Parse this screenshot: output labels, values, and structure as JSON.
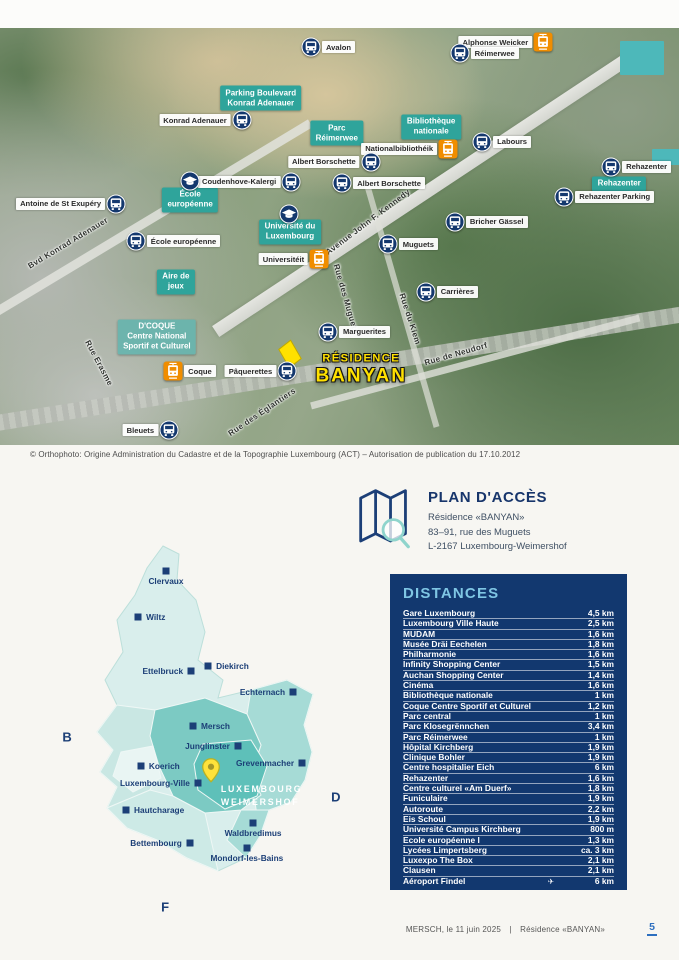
{
  "page": {
    "copyright": "© Orthophoto: Origine Administration du Cadastre et de la Topographie Luxembourg (ACT) – Autorisation de publication du 17.10.2012",
    "footer": {
      "left": "MERSCH, le 11 juin 2025",
      "separator": "|",
      "right": "Résidence «BANYAN»",
      "page_number": "5"
    }
  },
  "colors": {
    "teal_label": "#2fa49b",
    "navy_panel": "#12386f",
    "bus_icon_navy": "#14386e",
    "tram_icon_orange": "#f08d00",
    "residence_yellow": "#ffe100",
    "distances_title_blue": "#7fc6e4",
    "page_number_blue": "#2d6fbf",
    "city_navy": "#1c3f77"
  },
  "aerial_map": {
    "area_labels": [
      {
        "text": "Parking Boulevard\nKonrad Adenauer",
        "x": 38.4,
        "y": 16.8
      },
      {
        "text": "Parc\nRéimerwee",
        "x": 49.6,
        "y": 25.2
      },
      {
        "text": "Bibliothèque\nnationale",
        "x": 63.5,
        "y": 23.7
      },
      {
        "text": "École\neuropéenne",
        "x": 28.0,
        "y": 41.2
      },
      {
        "text": "Université du\nLuxembourg",
        "x": 42.7,
        "y": 48.9
      },
      {
        "text": "Aire de\njeux",
        "x": 25.9,
        "y": 60.9
      },
      {
        "text": "Rehazenter",
        "x": 91.2,
        "y": 37.4
      },
      {
        "text": "D'COQUE\nCentre National\nSportif et Culturel",
        "x": 23.1,
        "y": 74.1,
        "variant": "coque"
      }
    ],
    "stops": [
      {
        "type": "bus",
        "label": "Avalon",
        "side": "right",
        "x": 45.8,
        "y": 4.6
      },
      {
        "type": "tram",
        "label": "Alphonse Weicker",
        "side": "left",
        "x": 80.0,
        "y": 3.4
      },
      {
        "type": "bus",
        "label": "Réimerwee",
        "side": "right",
        "x": 67.7,
        "y": 6.0
      },
      {
        "type": "bus",
        "label": "Konrad Adenauer",
        "side": "left",
        "x": 35.6,
        "y": 22.1
      },
      {
        "type": "tram",
        "label": "Nationalbibliothéik",
        "side": "left",
        "x": 66.0,
        "y": 29.0
      },
      {
        "type": "bus",
        "label": "Labours",
        "side": "right",
        "x": 71.0,
        "y": 27.3
      },
      {
        "type": "bus",
        "label": "Albert Borschette",
        "side": "left",
        "x": 54.6,
        "y": 32.1
      },
      {
        "type": "bus",
        "label": "Albert Borschette",
        "side": "right",
        "x": 50.4,
        "y": 37.2
      },
      {
        "type": "bus",
        "label": "Coudenhove-Kalergi",
        "side": "left",
        "x": 42.9,
        "y": 36.9
      },
      {
        "type": "school",
        "label": "",
        "side": "right",
        "x": 28.0,
        "y": 36.7
      },
      {
        "type": "bus",
        "label": "Antoine de St Exupéry",
        "side": "left",
        "x": 17.1,
        "y": 42.2
      },
      {
        "type": "bus",
        "label": "École européenne",
        "side": "right",
        "x": 20.0,
        "y": 51.1
      },
      {
        "type": "school",
        "label": "",
        "side": "right",
        "x": 42.6,
        "y": 44.6
      },
      {
        "type": "tram",
        "label": "Universitéit",
        "side": "left",
        "x": 47.0,
        "y": 55.4
      },
      {
        "type": "bus",
        "label": "Muguets",
        "side": "right",
        "x": 57.1,
        "y": 51.8
      },
      {
        "type": "bus",
        "label": "Bricher Gässel",
        "side": "right",
        "x": 67.0,
        "y": 46.5
      },
      {
        "type": "bus",
        "label": "Rehazenter",
        "side": "right",
        "x": 90.0,
        "y": 33.3
      },
      {
        "type": "bus",
        "label": "Rehazenter Parking",
        "side": "right",
        "x": 83.1,
        "y": 40.5
      },
      {
        "type": "bus",
        "label": "Carrières",
        "side": "right",
        "x": 62.7,
        "y": 63.3
      },
      {
        "type": "bus",
        "label": "Marguerites",
        "side": "right",
        "x": 48.3,
        "y": 72.9
      },
      {
        "type": "bus",
        "label": "Pâquerettes",
        "side": "left",
        "x": 42.3,
        "y": 82.3
      },
      {
        "type": "tram",
        "label": "Coque",
        "side": "right",
        "x": 25.5,
        "y": 82.3
      },
      {
        "type": "bus",
        "label": "Bleuets",
        "side": "left",
        "x": 24.9,
        "y": 96.5
      }
    ],
    "streets": [
      {
        "name": "Avenue John F. Kennedy",
        "x": 54.2,
        "y": 46.5,
        "rot": -37
      },
      {
        "name": "Bvd Konrad Adenauer",
        "x": 10.0,
        "y": 51.6,
        "rot": -31
      },
      {
        "name": "Rue Erasme",
        "x": 14.6,
        "y": 80.3,
        "rot": 62
      },
      {
        "name": "Rue des Muguets",
        "x": 51.0,
        "y": 65.0,
        "rot": 74
      },
      {
        "name": "Rue du Kiem",
        "x": 60.4,
        "y": 69.8,
        "rot": 72
      },
      {
        "name": "Rue de Neudorf",
        "x": 67.2,
        "y": 78.2,
        "rot": -16
      },
      {
        "name": "Rue des Églantiers",
        "x": 38.6,
        "y": 92.1,
        "rot": -34
      }
    ],
    "residence": {
      "line1": "RÉSIDENCE",
      "line2": "BANYAN"
    }
  },
  "access": {
    "title": "PLAN D'ACCÈS",
    "address_lines": [
      "Résidence «BANYAN»",
      "83–91, rue des Muguets",
      "L-2167 Luxembourg-Weimershof"
    ]
  },
  "distances": {
    "title": "DISTANCES",
    "rows": [
      {
        "place": "Gare Luxembourg",
        "distance": "4,5 km"
      },
      {
        "place": "Luxembourg Ville Haute",
        "distance": "2,5 km"
      },
      {
        "place": "MUDAM",
        "distance": "1,6 km"
      },
      {
        "place": "Musée Dräi Eechelen",
        "distance": "1,8 km"
      },
      {
        "place": "Philharmonie",
        "distance": "1,6 km"
      },
      {
        "place": "Infinity Shopping Center",
        "distance": "1,5 km"
      },
      {
        "place": "Auchan Shopping Center",
        "distance": "1,4 km"
      },
      {
        "place": "Cinéma",
        "distance": "1,6 km"
      },
      {
        "place": "Bibliothèque nationale",
        "distance": "1 km"
      },
      {
        "place": "Coque Centre Sportif et Culturel",
        "distance": "1,2 km"
      },
      {
        "place": "Parc central",
        "distance": "1 km"
      },
      {
        "place": "Parc Klosegrënnchen",
        "distance": "3,4 km"
      },
      {
        "place": "Parc Réimerwee",
        "distance": "1 km"
      },
      {
        "place": "Hôpital Kirchberg",
        "distance": "1,9 km"
      },
      {
        "place": "Clinique Bohler",
        "distance": "1,9 km"
      },
      {
        "place": "Centre hospitalier Eich",
        "distance": "6 km"
      },
      {
        "place": "Rehazenter",
        "distance": "1,6 km"
      },
      {
        "place": "Centre culturel «Am Duerf»",
        "distance": "1,8 km"
      },
      {
        "place": "Funiculaire",
        "distance": "1,9 km"
      },
      {
        "place": "Autoroute",
        "distance": "2,2 km"
      },
      {
        "place": "Eis Schoul",
        "distance": "1,9 km"
      },
      {
        "place": "Université Campus Kirchberg",
        "distance": "800 m"
      },
      {
        "place": "Ecole européenne I",
        "distance": "1,3 km"
      },
      {
        "place": "Lycées Limpertsberg",
        "distance": "ca. 3 km"
      },
      {
        "place": "Luxexpo The Box",
        "distance": "2,1 km"
      },
      {
        "place": "Clausen",
        "distance": "2,1 km"
      },
      {
        "place": "Aéroport Findel",
        "distance": "6 km",
        "plane": true
      }
    ]
  },
  "lux_map": {
    "cities": [
      {
        "name": "Clervaux",
        "x": 35.8,
        "y": 8.1,
        "side": "below"
      },
      {
        "name": "Wiltz",
        "x": 26.8,
        "y": 20.0,
        "side": "right"
      },
      {
        "name": "Ettelbruck",
        "x": 43.9,
        "y": 34.0,
        "side": "left"
      },
      {
        "name": "Diekirch",
        "x": 49.4,
        "y": 32.7,
        "side": "right"
      },
      {
        "name": "Echternach",
        "x": 76.8,
        "y": 39.5,
        "side": "left"
      },
      {
        "name": "Mersch",
        "x": 44.5,
        "y": 48.3,
        "side": "right"
      },
      {
        "name": "Junglinster",
        "x": 59.0,
        "y": 53.5,
        "side": "left"
      },
      {
        "name": "Grevenmacher",
        "x": 79.7,
        "y": 57.9,
        "side": "left"
      },
      {
        "name": "Koerich",
        "x": 27.7,
        "y": 58.7,
        "side": "right"
      },
      {
        "name": "Luxembourg-Ville",
        "x": 46.1,
        "y": 63.1,
        "side": "left"
      },
      {
        "name": "Hautcharage",
        "x": 22.9,
        "y": 70.1,
        "side": "right"
      },
      {
        "name": "Waldbredimus",
        "x": 63.9,
        "y": 73.5,
        "side": "below"
      },
      {
        "name": "Bettembourg",
        "x": 43.5,
        "y": 78.7,
        "side": "left"
      },
      {
        "name": "Mondorf-les-Bains",
        "x": 61.9,
        "y": 80.0,
        "side": "below"
      }
    ],
    "highlight": {
      "line1": "LUXEMBOURG",
      "line2": "WEIMERSHOF"
    },
    "neighbors": [
      {
        "letter": "B",
        "x": 3.9,
        "y": 51.2
      },
      {
        "letter": "D",
        "x": 90.6,
        "y": 66.8
      },
      {
        "letter": "F",
        "x": 35.5,
        "y": 95.3
      }
    ]
  }
}
